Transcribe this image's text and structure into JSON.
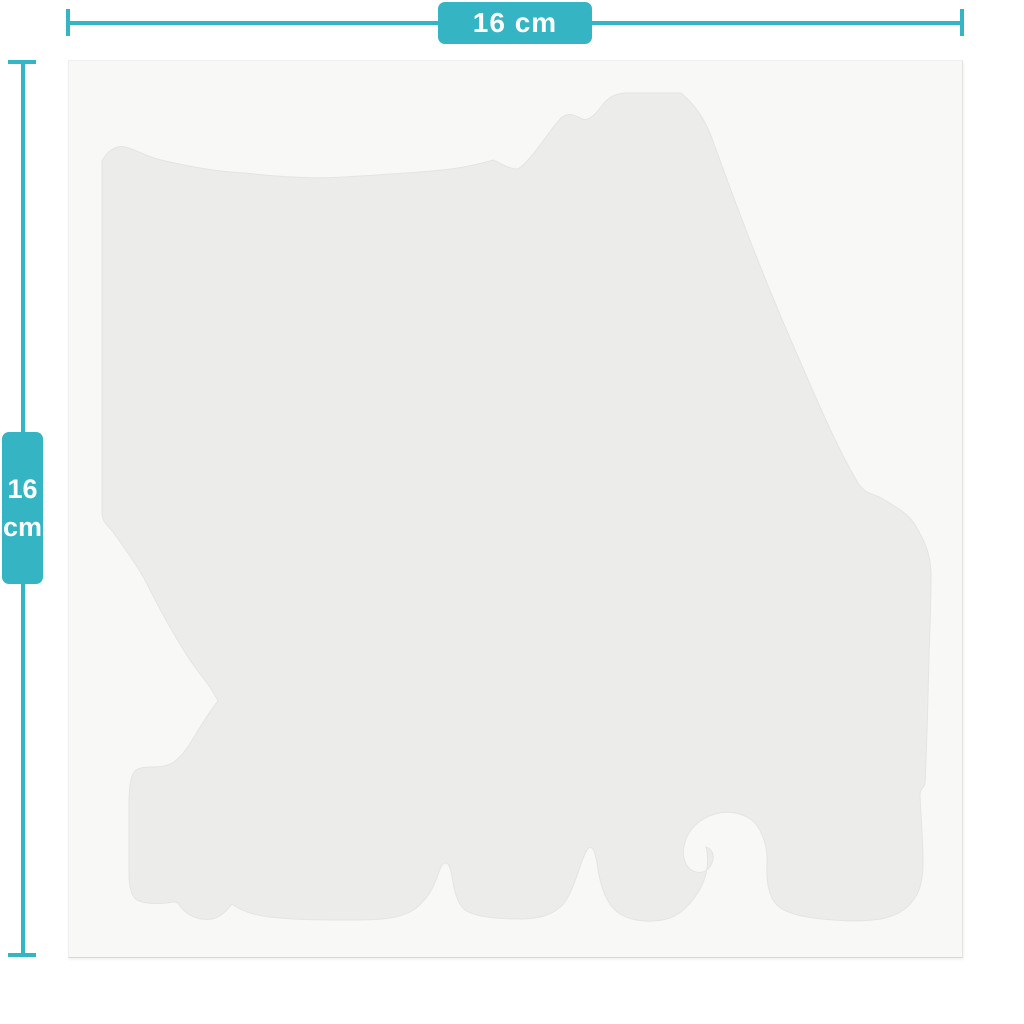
{
  "measurements": {
    "width": {
      "label": "16 cm"
    },
    "height": {
      "value": "16",
      "unit": "cm"
    }
  },
  "colors": {
    "accent": "#35b4c4",
    "label_text": "#ffffff",
    "canvas": "#f8f8f7",
    "shape": "#ececea",
    "background": "#ffffff"
  }
}
